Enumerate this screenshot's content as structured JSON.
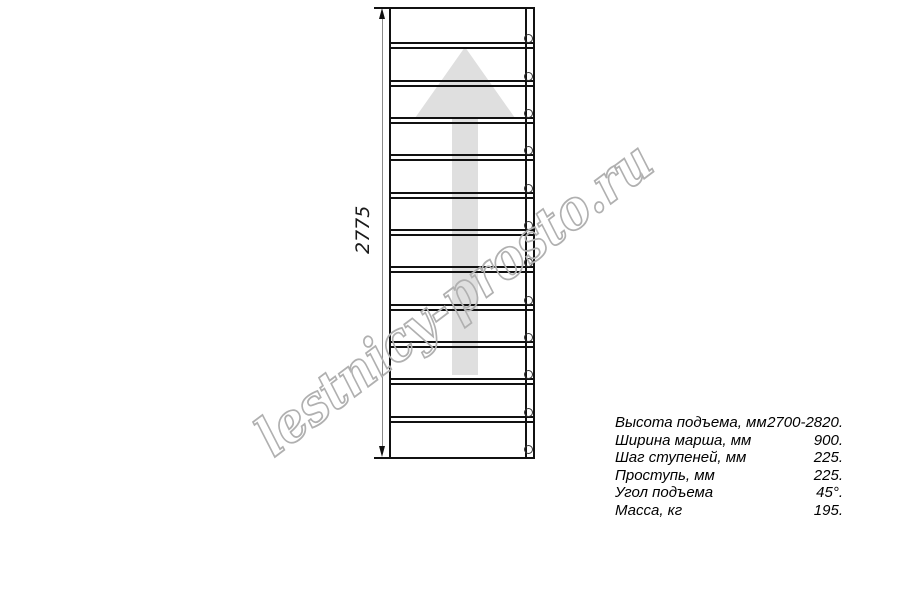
{
  "page": {
    "background": "#ffffff"
  },
  "diagram": {
    "type": "staircase-plan-top-view",
    "dimension_label": "2775",
    "tread_count": 12,
    "fastener_count": 12,
    "direction_arrow": "up",
    "colors": {
      "line": "#111111",
      "arrow_fill": "#dfdfdf",
      "dimension_line": "#8a8a8a",
      "watermark_outline": "#b0b0b0"
    }
  },
  "watermark": {
    "text": "lestnicy-prosto.ru"
  },
  "specs": {
    "rows": [
      {
        "label": "Высота подъема, мм",
        "value": "2700-2820."
      },
      {
        "label": "Ширина марша, мм",
        "value": "900."
      },
      {
        "label": "Шаг ступеней, мм",
        "value": "225."
      },
      {
        "label": "Проступь, мм",
        "value": "225."
      },
      {
        "label": "Угол подъема",
        "value": "45°."
      },
      {
        "label": "Масса, кг",
        "value": "195."
      }
    ]
  }
}
